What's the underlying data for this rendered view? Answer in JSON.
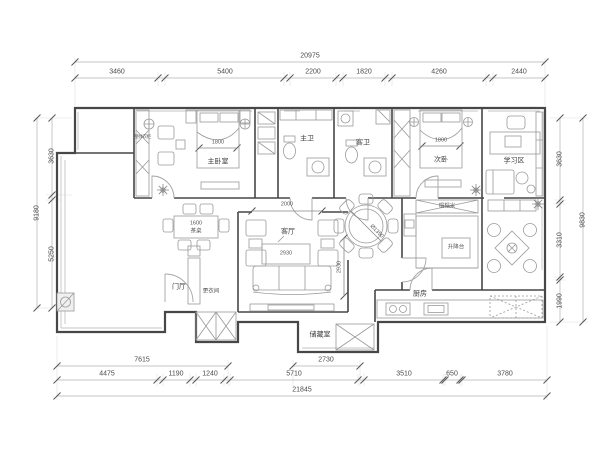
{
  "drawing": {
    "type": "apartment-floor-plan",
    "bg_color": "#ffffff",
    "wall_color": "#474747",
    "furniture_color": "#9a9a9a",
    "dim_color": "#4a4a4a"
  },
  "dimensions": {
    "top": {
      "total": "20975",
      "segments": [
        "3460",
        "5400",
        "2200",
        "1820",
        "4260",
        "2440"
      ]
    },
    "bottom": {
      "upper": [
        "7615",
        "2730"
      ],
      "main": [
        "4475",
        "1190",
        "1240",
        "5710",
        "3510",
        "650",
        "3780"
      ],
      "total": "21845"
    },
    "left": {
      "total": "9180",
      "segments": [
        "3630",
        "5250"
      ]
    },
    "right": {
      "total": "9830",
      "segments": [
        "3630",
        "3310",
        "1990"
      ]
    }
  },
  "rooms": {
    "master_bedroom": "主卧室",
    "master_bath": "主卫",
    "guest_bath": "客卫",
    "second_bedroom": "次卧",
    "study": "学习区",
    "living": "客厅",
    "foyer": "门厅",
    "dressing": "更衣间",
    "kitchen": "厨房",
    "storage": "储藏室",
    "tatami": "榻榻米",
    "wardrobe": "整体衣柜",
    "lift_table": "升降台",
    "tea_table": "茶桌"
  },
  "furniture_dims": {
    "master_bed": "1800",
    "second_bed": "1800",
    "coffee_table": "2930",
    "living_opening": "2000",
    "living_depth": "2930",
    "dining_table": "Ø1350",
    "tea_table_len": "1600"
  },
  "icons": {
    "plant": "radiating-star-plant-symbol",
    "ceiling_lamp": "circle-cross-lamp-symbol",
    "tick": "45deg-dimension-tick"
  }
}
